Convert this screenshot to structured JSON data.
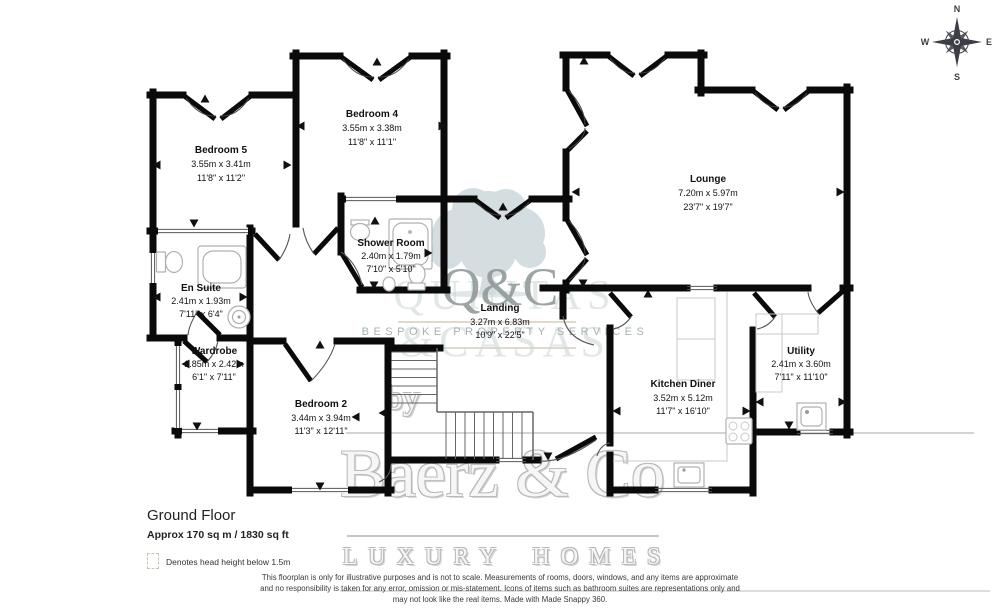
{
  "floor": {
    "title": "Ground Floor",
    "area": "Approx 170 sq m / 1830 sq ft"
  },
  "legend": {
    "note": "Denotes head height below 1.5m"
  },
  "rooms": [
    {
      "name": "Bedroom 5",
      "metric": "3.55m x 3.41m",
      "imperial": "11'8\" x 11'2\""
    },
    {
      "name": "Bedroom 4",
      "metric": "3.55m x 3.38m",
      "imperial": "11'8\" x 11'1\""
    },
    {
      "name": "Lounge",
      "metric": "7.20m x 5.97m",
      "imperial": "23'7\" x 19'7\""
    },
    {
      "name": "Shower Room",
      "metric": "2.40m x 1.79m",
      "imperial": "7'10\" x 5'10\""
    },
    {
      "name": "En Suite",
      "metric": "2.41m x 1.93m",
      "imperial": "7'11\" x 6'4\""
    },
    {
      "name": "Wardrobe",
      "metric": "1.85m x 2.42m",
      "imperial": "6'1\" x 7'11\""
    },
    {
      "name": "Landing",
      "metric": "3.27m x 6.83m",
      "imperial": "10'9\" x 22'5\""
    },
    {
      "name": "Bedroom 2",
      "metric": "3.44m x 3.94m",
      "imperial": "11'3\" x 12'11\""
    },
    {
      "name": "Kitchen Diner",
      "metric": "3.52m x 5.12m",
      "imperial": "11'7\" x 16'10\""
    },
    {
      "name": "Utility",
      "metric": "2.41m x 3.60m",
      "imperial": "7'11\" x 11'10\""
    }
  ],
  "compass": {
    "north": "N",
    "east": "E",
    "south": "S",
    "west": "W"
  },
  "watermark": {
    "logo": "Q&C",
    "brand_upper": "QUINTAS",
    "brand_lower": "&CASAS",
    "tagline": "BESPOKE PROPERTY SERVICES",
    "by": "by",
    "name": "Baerz & Co",
    "subtitle": "LUXURY HOMES"
  },
  "disclaimer": {
    "line1": "This floorplan is only for illustrative purposes and is not to scale. Measurements of rooms, doors, windows, and any items are approximate",
    "line2": "and no responsibility is taken for any error, omission or mis-statement. Icons of items such as bathroom suites are representations only and",
    "line3": "may not look like the real items. Made with Made Snappy 360."
  },
  "colors": {
    "wall": "#0a0a0a",
    "logo_teal": "#b9c8ca",
    "watermark_grey": "#c6c6c6",
    "label_text": "#111111"
  }
}
